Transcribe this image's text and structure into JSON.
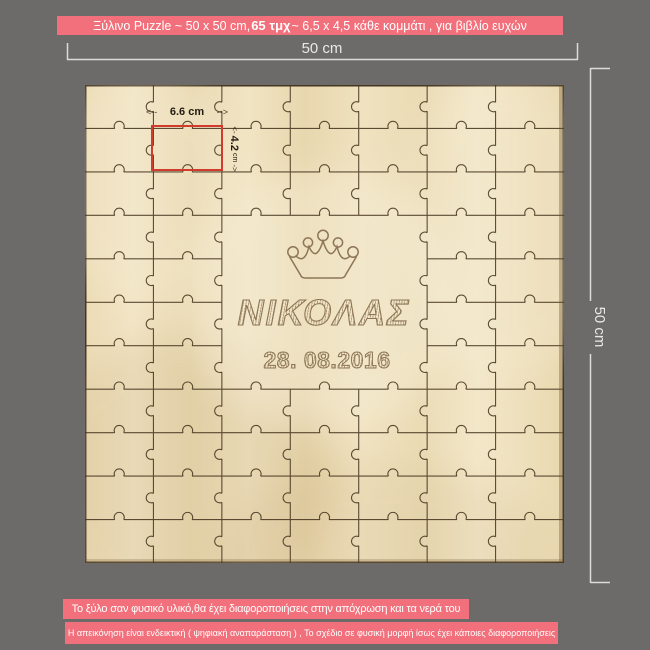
{
  "colors": {
    "background": "#6c6b69",
    "banner_bg": "#f2707b",
    "banner_text": "#ffffff",
    "wood_base": "#f0e2bf",
    "wood_light": "#f6ecd4",
    "wood_dark": "#c7ab7a",
    "wood_line": "#47361f",
    "wood_edge": "#6d5632",
    "highlight_red": "#d23a2c",
    "engraving": "#8d7656",
    "dimension": "#e9e8e6",
    "annotation_text": "#241b10"
  },
  "header_banner": {
    "part1": "Ξύλινο Puzzle ~ 50 x 50 cm, ",
    "bold_part": "65 τμχ",
    "part2": " ~ 6,5 x 4,5 κάθε κομμάτι , για βιβλίο ευχών"
  },
  "dimension_labels": {
    "width_label": "50 cm",
    "height_label": "50 cm",
    "piece_width": {
      "arrow_left": "<--",
      "value": "6.6 cm",
      "arrow_right": "-->"
    },
    "piece_height": {
      "arrow_start": "<-",
      "value": "4.2",
      "unit": "cm",
      "arrow_end": "->"
    }
  },
  "puzzle": {
    "engraving": {
      "name": "ΝΙΚΟΛΑΣ",
      "date": "28. 08.2016"
    },
    "grid": {
      "cols": 7,
      "rows": 11,
      "pieces_count": 65,
      "plaque": {
        "col_start": 2,
        "col_end": 5,
        "row_start": 3,
        "row_end": 7
      }
    }
  },
  "footer_notes": {
    "note1": "Το ξύλο σαν φυσικό υλικό,θα έχει  διαφοροποιήσεις στην απόχρωση και τα νερά του",
    "note2": "Η απεικόνηση είναι  ενδεικτική  ( ψηφιακή αναπαράσταση ) , Το σχέδιο σε φυσική μορφή ίσως έχει κάποιες διαφοροποιήσεις"
  }
}
